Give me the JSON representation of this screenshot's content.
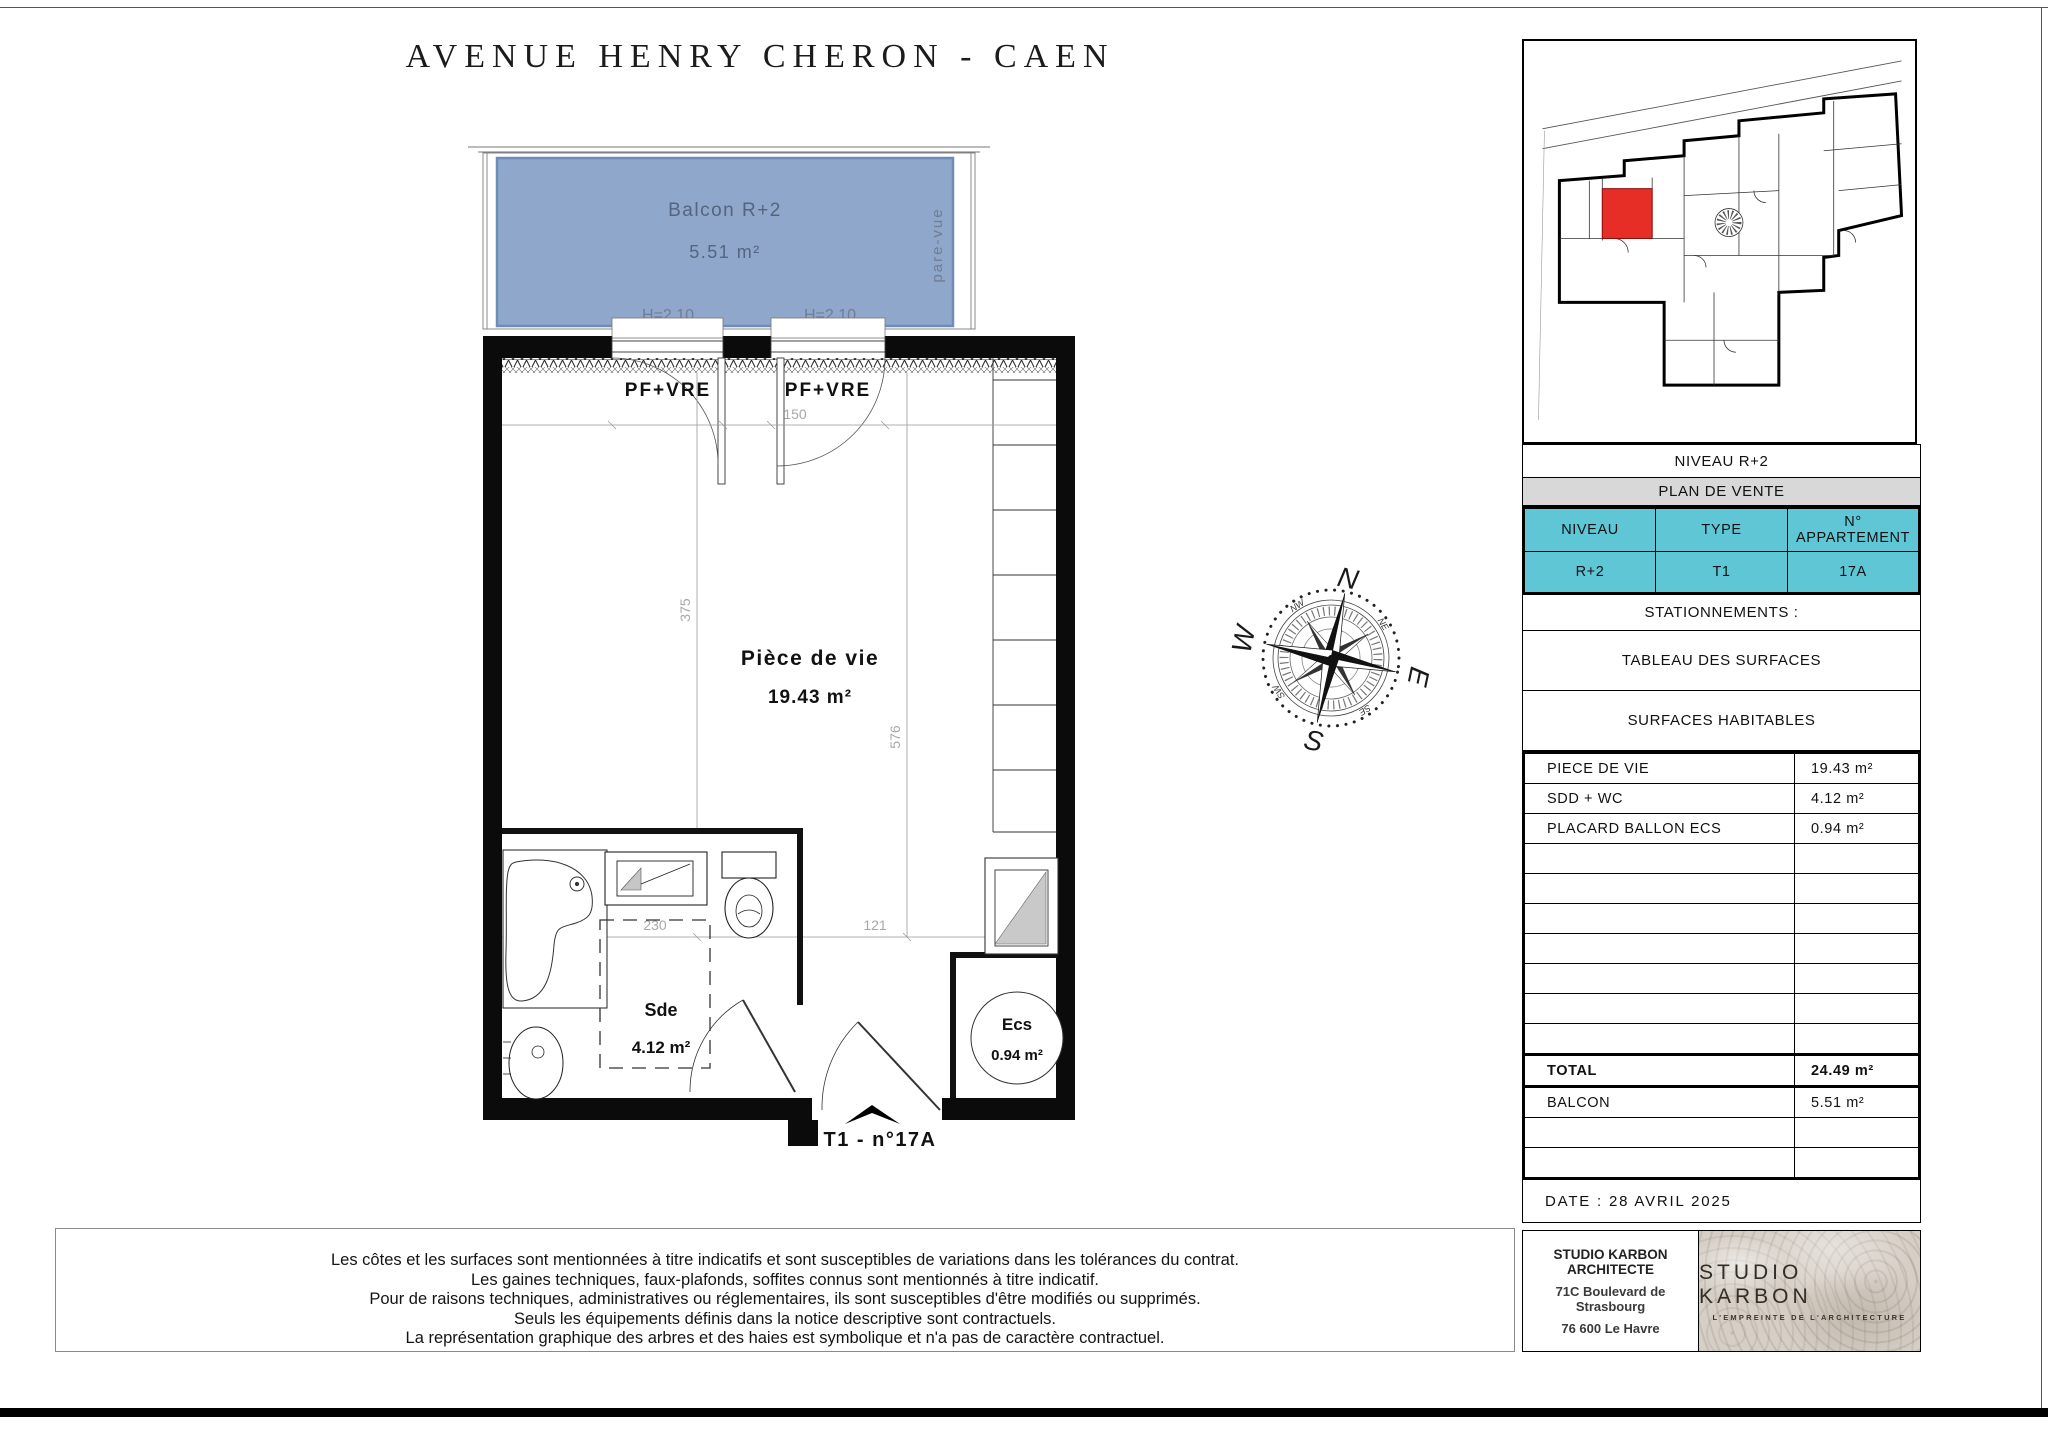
{
  "title": "AVENUE HENRY CHERON - CAEN",
  "colors": {
    "balcony_fill": "#8ea7ca",
    "balcony_stroke": "#6f8cb8",
    "balcony_text": "#55657f",
    "cyan_cell": "#5fc6d6",
    "gray_header": "#d8d8d8",
    "key_unit_red": "#e62e26",
    "dimension_gray": "#a8a8a8"
  },
  "plan": {
    "balcony": {
      "name": "Balcon R+2",
      "area": "5.51 m²",
      "screen": "pare-vue",
      "h1": "H=2.10",
      "h2": "H=2.10"
    },
    "window1": "PF+VRE",
    "window2": "PF+VRE",
    "living": {
      "name": "Pièce de vie",
      "area": "19.43 m²"
    },
    "shower_room": {
      "name": "Sde",
      "area": "4.12 m²"
    },
    "water_heater": {
      "name": "Ecs",
      "area": "0.94 m²"
    },
    "dims": {
      "d150": "150",
      "d375": "375",
      "d576": "576",
      "d230": "230",
      "d121": "121",
      "d194": "194"
    },
    "unit_label": "T1 - n°17A"
  },
  "compass": {
    "n": "N",
    "e": "E",
    "s": "S",
    "w": "W",
    "ne": "NE",
    "nw": "NW",
    "se": "SE",
    "sw": "SW"
  },
  "panel": {
    "level_caption": "NIVEAU R+2",
    "sale_header": "PLAN DE VENTE",
    "unit_table": {
      "h_niveau": "NIVEAU",
      "h_type": "TYPE",
      "h_num": "N° APPARTEMENT",
      "niveau": "R+2",
      "type": "T1",
      "num": "17A"
    },
    "parking": "STATIONNEMENTS :",
    "surfaces_title": "TABLEAU DES SURFACES",
    "habitables_title": "SURFACES HABITABLES",
    "rows": [
      {
        "label": "PIECE DE VIE",
        "value": "19.43 m²"
      },
      {
        "label": "SDD + WC",
        "value": "4.12 m²"
      },
      {
        "label": "PLACARD BALLON ECS",
        "value": "0.94 m²"
      }
    ],
    "total": {
      "label": "TOTAL",
      "value": "24.49 m²"
    },
    "balcon": {
      "label": "BALCON",
      "value": "5.51 m²"
    },
    "date": "DATE : 28 AVRIL 2025"
  },
  "footer": {
    "disclaimer": [
      "Les côtes et les surfaces sont mentionnées à titre indicatifs et sont susceptibles de variations dans les tolérances du contrat.",
      "Les gaines techniques, faux-plafonds, soffites connus sont mentionnés à titre indicatif.",
      "Pour de raisons techniques, administratives ou réglementaires, ils sont susceptibles d'être modifiés ou supprimés.",
      "Seuls les équipements définis dans la notice descriptive sont contractuels.",
      "La représentation graphique  des arbres et des haies est symbolique et n'a pas de caractère contractuel."
    ],
    "architect_line1": "STUDIO KARBON ARCHITECTE",
    "architect_line2": "71C Boulevard de Strasbourg",
    "architect_line3": "76 600 Le Havre",
    "logo_name": "STUDIO KARBON",
    "logo_tagline": "L'EMPREINTE DE L'ARCHITECTURE"
  }
}
